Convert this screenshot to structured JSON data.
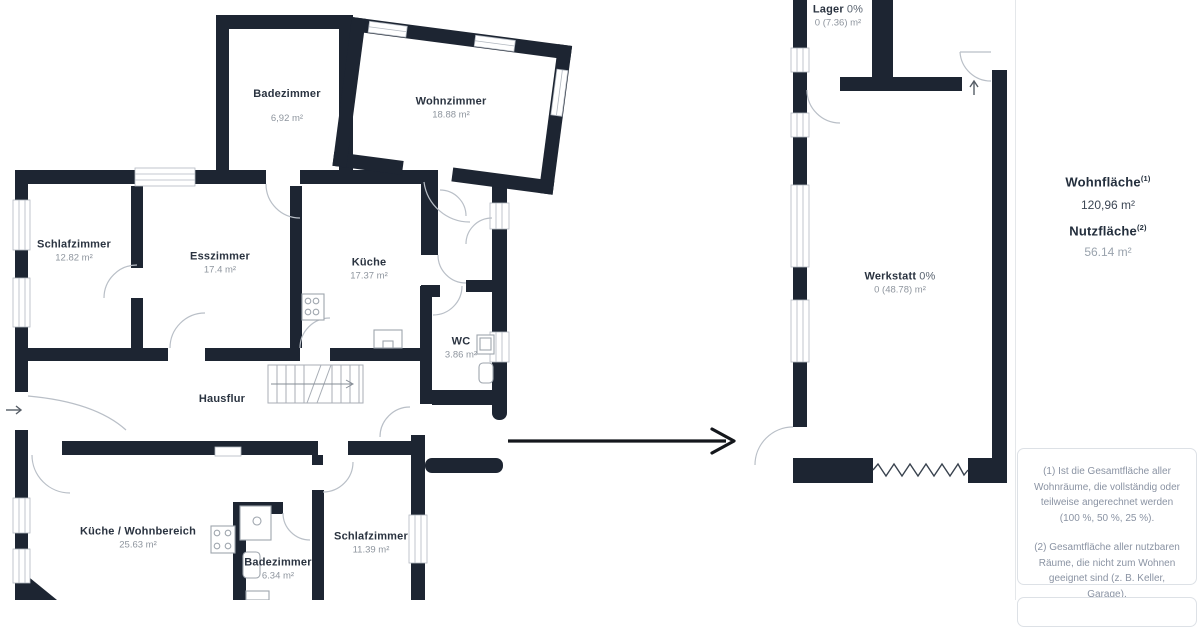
{
  "plan": {
    "rooms": [
      {
        "id": "badezimmer-og",
        "name": "Badezimmer",
        "area": "6,92 m²"
      },
      {
        "id": "wohnzimmer",
        "name": "Wohnzimmer",
        "area": "18.88 m²"
      },
      {
        "id": "schlafzimmer-og",
        "name": "Schlafzimmer",
        "area": "12.82 m²"
      },
      {
        "id": "esszimmer",
        "name": "Esszimmer",
        "area": "17.4 m²"
      },
      {
        "id": "kueche",
        "name": "Küche",
        "area": "17.37 m²"
      },
      {
        "id": "wc",
        "name": "WC",
        "area": "3.86 m²"
      },
      {
        "id": "hausflur",
        "name": "Hausflur",
        "area": ""
      },
      {
        "id": "kueche-wohnbereich",
        "name": "Küche / Wohnbereich",
        "area": "25.63 m²"
      },
      {
        "id": "badezimmer-eg",
        "name": "Badezimmer",
        "area": "6.34 m²"
      },
      {
        "id": "schlafzimmer-eg",
        "name": "Schlafzimmer",
        "area": "11.39 m²"
      },
      {
        "id": "lager",
        "name": "Lager",
        "pct": "0%",
        "area": "0 (7.36) m²"
      },
      {
        "id": "werkstatt",
        "name": "Werkstatt",
        "pct": "0%",
        "area": "0 (48.78) m²"
      }
    ]
  },
  "sidebar": {
    "wohnflaeche": {
      "label": "Wohnfläche",
      "sup": "(1)",
      "value": "120,96 m²"
    },
    "nutzflaeche": {
      "label": "Nutzfläche",
      "sup": "(2)",
      "value": "56.14 m²"
    },
    "footnotes": [
      "(1) Ist die Gesamtfläche aller Wohnräume, die vollständig oder teilweise angerechnet werden (100 %, 50 %, 25 %).",
      "(2) Gesamtfläche aller nutzbaren Räume, die nicht zum Wohnen geeignet sind (z. B. Keller, Garage)."
    ]
  },
  "colors": {
    "wall": "#1d2532",
    "room_name_text": "#2a3340",
    "muted_text": "#8e959e",
    "footnote_text": "#8a93a3"
  }
}
